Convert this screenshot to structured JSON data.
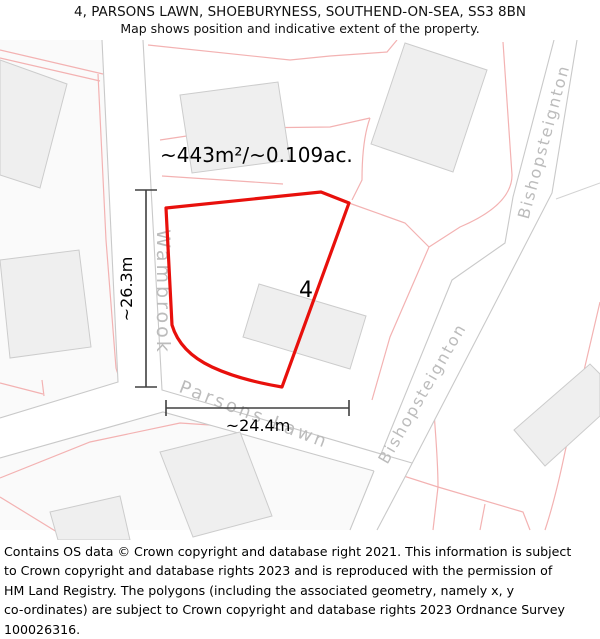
{
  "header": {
    "line1": "4, PARSONS LAWN, SHOEBURYNESS, SOUTHEND-ON-SEA, SS3 8BN",
    "line2": "Map shows position and indicative extent of the property."
  },
  "map": {
    "area_label": "~443m²/~0.109ac.",
    "plot_number": "4",
    "dimensions": {
      "vertical": "~26.3m",
      "horizontal": "~24.4m"
    },
    "streets": {
      "wambrook": "Wambrook",
      "parsons_lawn": "Parsons Lawn",
      "bishopsteignton_lower": "Bishopsteignton",
      "bishopsteignton_upper": "Bishopsteignton"
    },
    "colors": {
      "property_outline": "#e8100c",
      "parcel_line": "#f3b2b2",
      "road_edge": "#c9c9c9",
      "building_fill": "#efefef",
      "street_label": "#bcbcbc"
    }
  },
  "footer": {
    "lines": [
      "Contains OS data © Crown copyright and database right 2021. This information is subject",
      "to Crown copyright and database rights 2023 and is reproduced with the permission of",
      "HM Land Registry. The polygons (including the associated geometry, namely x, y",
      "co-ordinates) are subject to Crown copyright and database rights 2023 Ordnance Survey",
      "100026316."
    ]
  }
}
